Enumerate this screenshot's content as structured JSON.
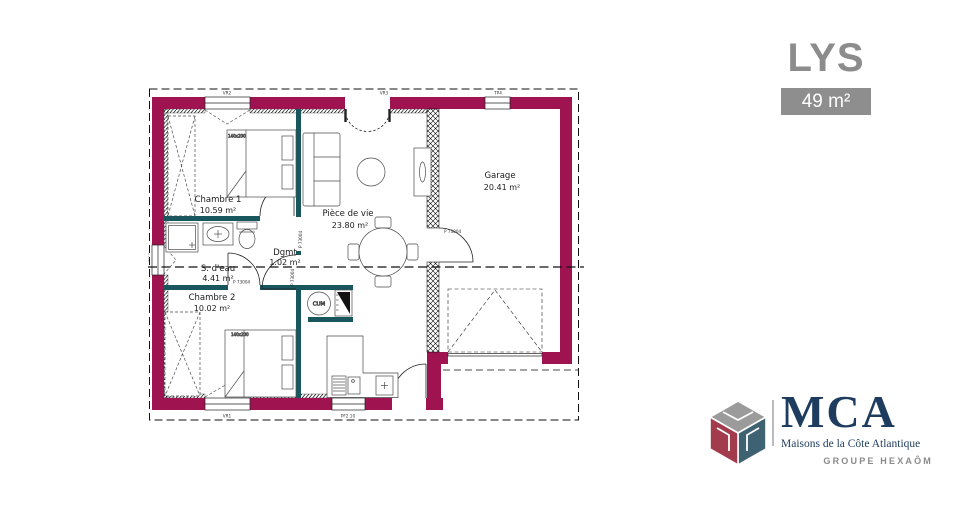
{
  "panel": {
    "title": "LYS",
    "area_badge": "49 m²"
  },
  "plan": {
    "rooms": [
      {
        "name": "Chambre 1",
        "area": "10.59 m²"
      },
      {
        "name": "Pièce de vie",
        "area": "23.80 m²"
      },
      {
        "name": "Garage",
        "area": "20.41 m²"
      },
      {
        "name": "S. d'eau",
        "area": "4.41 m²"
      },
      {
        "name": "Dgmt",
        "area": "1.02 m²"
      },
      {
        "name": "Chambre 2",
        "area": "10.02 m²"
      }
    ],
    "door_ref": "P 73004",
    "bed_size": "140x200",
    "water_heater": "CUM",
    "window_refs": {
      "top_left": "VR2",
      "top_center": "VR3",
      "top_right": "TP4",
      "bottom_left": "VR1",
      "bottom_center": "PF2.10",
      "left": "0.60"
    },
    "colors": {
      "exterior_wall": "#9E1350",
      "interior_wall": "#19575F"
    }
  },
  "logo": {
    "brand": "MCA",
    "tagline": "Maisons de la Côte Atlantique",
    "group": "GROUPE HEXAÔM"
  }
}
